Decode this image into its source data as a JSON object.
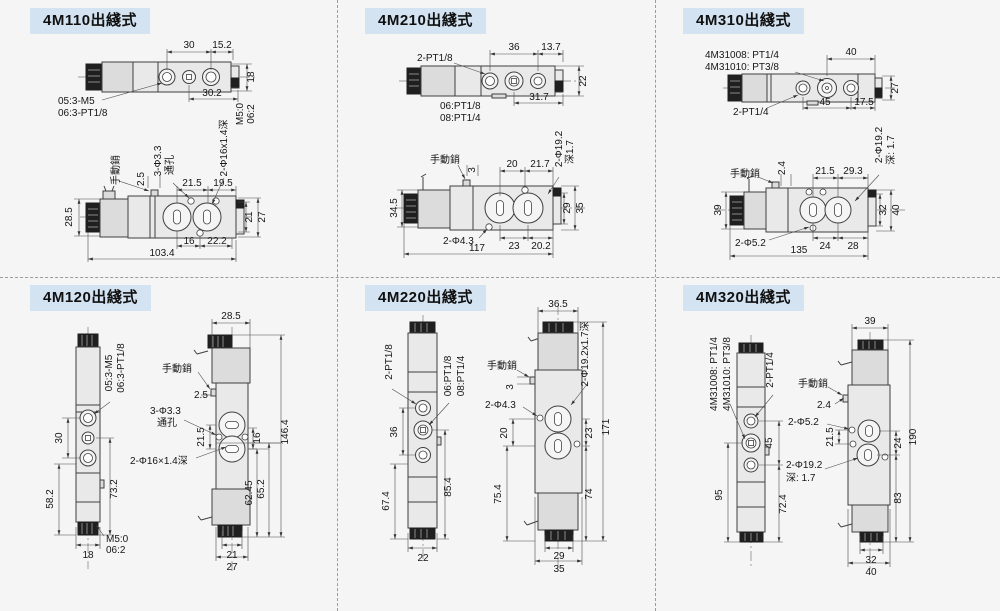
{
  "page": {
    "badge_bg": "#d4e3f2",
    "background": "#f5f5f6",
    "line_color": "#3f3f3f",
    "divider_color": "#9b9b9b"
  },
  "panels": [
    {
      "title": "4M110出綫式",
      "top": {
        "dim_30": "30",
        "dim_15_2": "15.2",
        "dim_18": "18",
        "dim_30_2": "30.2",
        "note_05": "05:3-M5",
        "note_06": "06:3-PT1/8",
        "vnote1": "M5:0",
        "vnote2": "06:2"
      },
      "side": {
        "manual": "手動銷",
        "dim_2_5": "2.5",
        "hole_note1": "3-Φ3.3",
        "hole_note2": "通孔",
        "dim_21_5": "21.5",
        "dim_19_5": "19.5",
        "cbore": "2-Φ16x1.4深",
        "dim_28_5": "28.5",
        "dim_21": "21",
        "dim_27": "27",
        "dim_16": "16",
        "dim_22_2": "22.2",
        "dim_103_4": "103.4"
      }
    },
    {
      "title": "4M210出綫式",
      "top": {
        "note_ports": "2-PT1/8",
        "dim_36": "36",
        "dim_13_7": "13.7",
        "dim_22": "22",
        "note_06": "06:PT1/8",
        "note_08": "08:PT1/4",
        "dim_31_7": "31.7"
      },
      "side": {
        "manual": "手動銷",
        "dim_3": "3",
        "dim_20": "20",
        "dim_21_7": "21.7",
        "cbore1": "2-Φ19.2",
        "cbore2": "深1.7",
        "dim_34_5": "34.5",
        "dim_29": "29",
        "dim_35": "35",
        "hole_note": "2-Φ4.3",
        "dim_23": "23",
        "dim_20_2": "20.2",
        "dim_117": "117"
      }
    },
    {
      "title": "4M310出綫式",
      "top": {
        "note_08": "4M31008: PT1/4",
        "note_10": "4M31010: PT3/8",
        "dim_40": "40",
        "dim_27": "27",
        "note_ports": "2-PT1/4",
        "dim_45": "45",
        "dim_17_5": "17.5"
      },
      "side": {
        "manual": "手動銷",
        "dim_2_4": "2.4",
        "dim_21_5": "21.5",
        "dim_29_3": "29.3",
        "cbore1": "2-Φ19.2",
        "cbore2": "深: 1.7",
        "dim_39": "39",
        "dim_32": "32",
        "dim_40": "40",
        "hole_note": "2-Φ5.2",
        "dim_24": "24",
        "dim_28": "28",
        "dim_135": "135"
      }
    },
    {
      "title": "4M120出綫式",
      "front": {
        "note_05": "05:3-M5",
        "note_06": "06:3-PT1/8",
        "dim_30": "30",
        "dim_58_2": "58.2",
        "dim_73_2": "73.2",
        "dim_18": "18",
        "vnote1": "M5:0",
        "vnote2": "06:2"
      },
      "side": {
        "dim_28_5": "28.5",
        "manual": "手動銷",
        "dim_2_5": "2.5",
        "hole_note1": "3-Φ3.3",
        "hole_note2": "通孔",
        "dim_21_5": "21.5",
        "dim_16": "16",
        "dim_146_4": "146.4",
        "cbore": "2-Φ16×1.4深",
        "dim_62_45": "62.45",
        "dim_65_2": "65.2",
        "dim_21": "21",
        "dim_27": "27"
      }
    },
    {
      "title": "4M220出綫式",
      "front": {
        "note_ports": "2-PT1/8",
        "note_06": "06:PT1/8",
        "note_08": "08:PT1/4",
        "dim_36": "36",
        "dim_67_4": "67.4",
        "dim_85_4": "85.4",
        "dim_22": "22"
      },
      "side": {
        "dim_36_5": "36.5",
        "manual": "手動銷",
        "dim_3": "3",
        "hole_note": "2-Φ4.3",
        "cbore": "2-Φ19.2x1.7深",
        "dim_20": "20",
        "dim_75_4": "75.4",
        "dim_23": "23",
        "dim_171": "171",
        "dim_74": "74",
        "dim_29": "29",
        "dim_35": "35"
      }
    },
    {
      "title": "4M320出綫式",
      "front": {
        "note_08": "4M31008: PT1/4",
        "note_10": "4M31010: PT3/8",
        "note_ports": "2-PT1/4",
        "dim_45": "45",
        "dim_95": "95",
        "dim_72_4": "72.4"
      },
      "side": {
        "dim_39": "39",
        "manual": "手動銷",
        "dim_2_4": "2.4",
        "hole_note": "2-Φ5.2",
        "dim_21_5": "21.5",
        "dim_24": "24",
        "dim_190": "190",
        "cbore1": "2-Φ19.2",
        "cbore2": "深: 1.7",
        "dim_83": "83",
        "dim_32": "32",
        "dim_40": "40"
      }
    }
  ]
}
